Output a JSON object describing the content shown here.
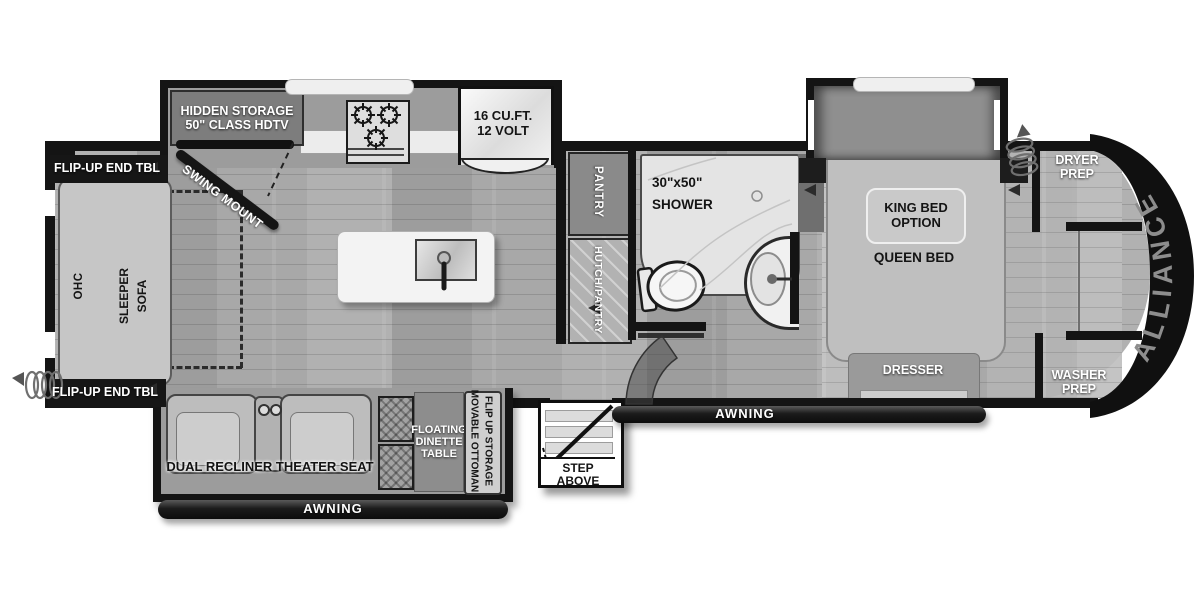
{
  "brand": {
    "name": "ALLIANCE"
  },
  "rear_living": {
    "flip_up_end_table_top": "FLIP-UP END TBL",
    "flip_up_end_table_bottom": "FLIP-UP END TBL",
    "ohc": "OHC",
    "sleeper_line1": "SLEEPER",
    "sleeper_line2": "SOFA",
    "hidden_storage_line1": "HIDDEN STORAGE",
    "hidden_storage_line2": "50\" CLASS HDTV",
    "swing_mount": "SWING MOUNT"
  },
  "kitchen": {
    "fridge_line1": "16 CU.FT.",
    "fridge_line2": "12 VOLT",
    "pantry": "PANTRY",
    "hutch_pantry": "HUTCH/PANTRY"
  },
  "bathroom": {
    "shower_line1": "30\"x50\"",
    "shower_line2": "SHOWER"
  },
  "bedroom": {
    "king_option_line1": "KING BED",
    "king_option_line2": "OPTION",
    "queen_bed": "QUEEN BED",
    "dresser": "DRESSER"
  },
  "front": {
    "dryer_line1": "DRYER",
    "dryer_line2": "PREP",
    "washer_line1": "WASHER",
    "washer_line2": "PREP"
  },
  "bottom_slide": {
    "theater_seat": "DUAL RECLINER THEATER SEAT",
    "dinette_line1": "FLOATING",
    "dinette_line2": "DINETTE",
    "dinette_line3": "TABLE",
    "movable_line1": "MOVABLE OTTOMAN",
    "movable_line2": "FLIP UP STORAGE",
    "awning": "AWNING"
  },
  "exterior": {
    "awning_main": "AWNING",
    "step_above": "STEP ABOVE"
  },
  "icons": {
    "burner": "burner-icon",
    "coil_cord": "coil-cord-icon",
    "speaker": "speaker-icon",
    "toilet": "toilet-icon",
    "sink_faucet": "sink-faucet-icon",
    "steps": "steps-icon",
    "swing_tv": "swing-tv-icon"
  },
  "colors": {
    "wall": "#141414",
    "floor": "#a7a7a7",
    "slide_floor": "#9a9a9a",
    "front_cap": "#101010",
    "brand_text": "#8d8d8d",
    "label_on_dark": "#ffffff",
    "label_on_light": "#141414"
  }
}
